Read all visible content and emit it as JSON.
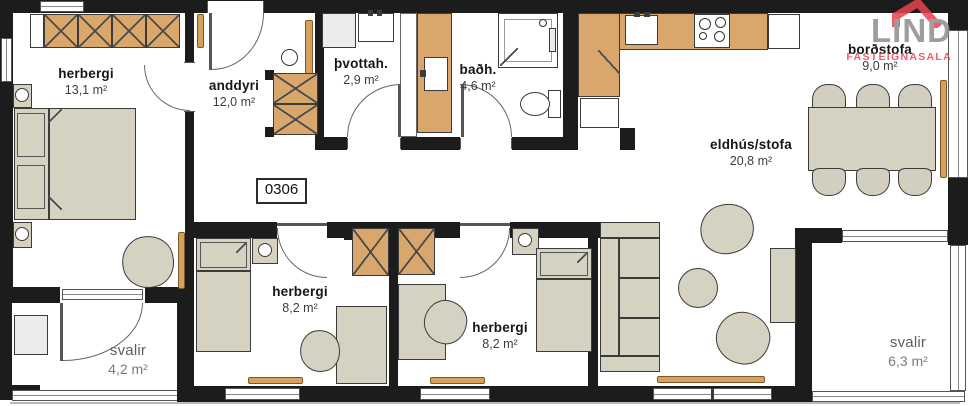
{
  "unit_label": "0306",
  "logo": {
    "brand": "LIND",
    "tagline": "FASTEIGNASALA"
  },
  "rooms": {
    "master": {
      "name": "herbergi",
      "area": "13,1 m²"
    },
    "anddyri": {
      "name": "anddyri",
      "area": "12,0 m²"
    },
    "laundry": {
      "name": "þvottah.",
      "area": "2,9 m²"
    },
    "bath": {
      "name": "baðh.",
      "area": "4,6 m²"
    },
    "dining": {
      "name": "borðstofa",
      "area": "9,0 m²"
    },
    "kitchen_living": {
      "name": "eldhús/stofa",
      "area": "20,8 m²"
    },
    "bedroom1": {
      "name": "herbergi",
      "area": "8,2 m²"
    },
    "bedroom2": {
      "name": "herbergi",
      "area": "8,2 m²"
    },
    "balcony1": {
      "name": "svalir",
      "area": "4,2 m²"
    },
    "balcony2": {
      "name": "svalir",
      "area": "6,3 m²"
    }
  },
  "colors": {
    "wall": "#1c1c1c",
    "cabinet_wood": "#d9a76c",
    "furniture": "#d6d2c2",
    "radiator": "#d9a05c",
    "logo_red": "#e8434d",
    "logo_gray": "#8e8e8e"
  }
}
